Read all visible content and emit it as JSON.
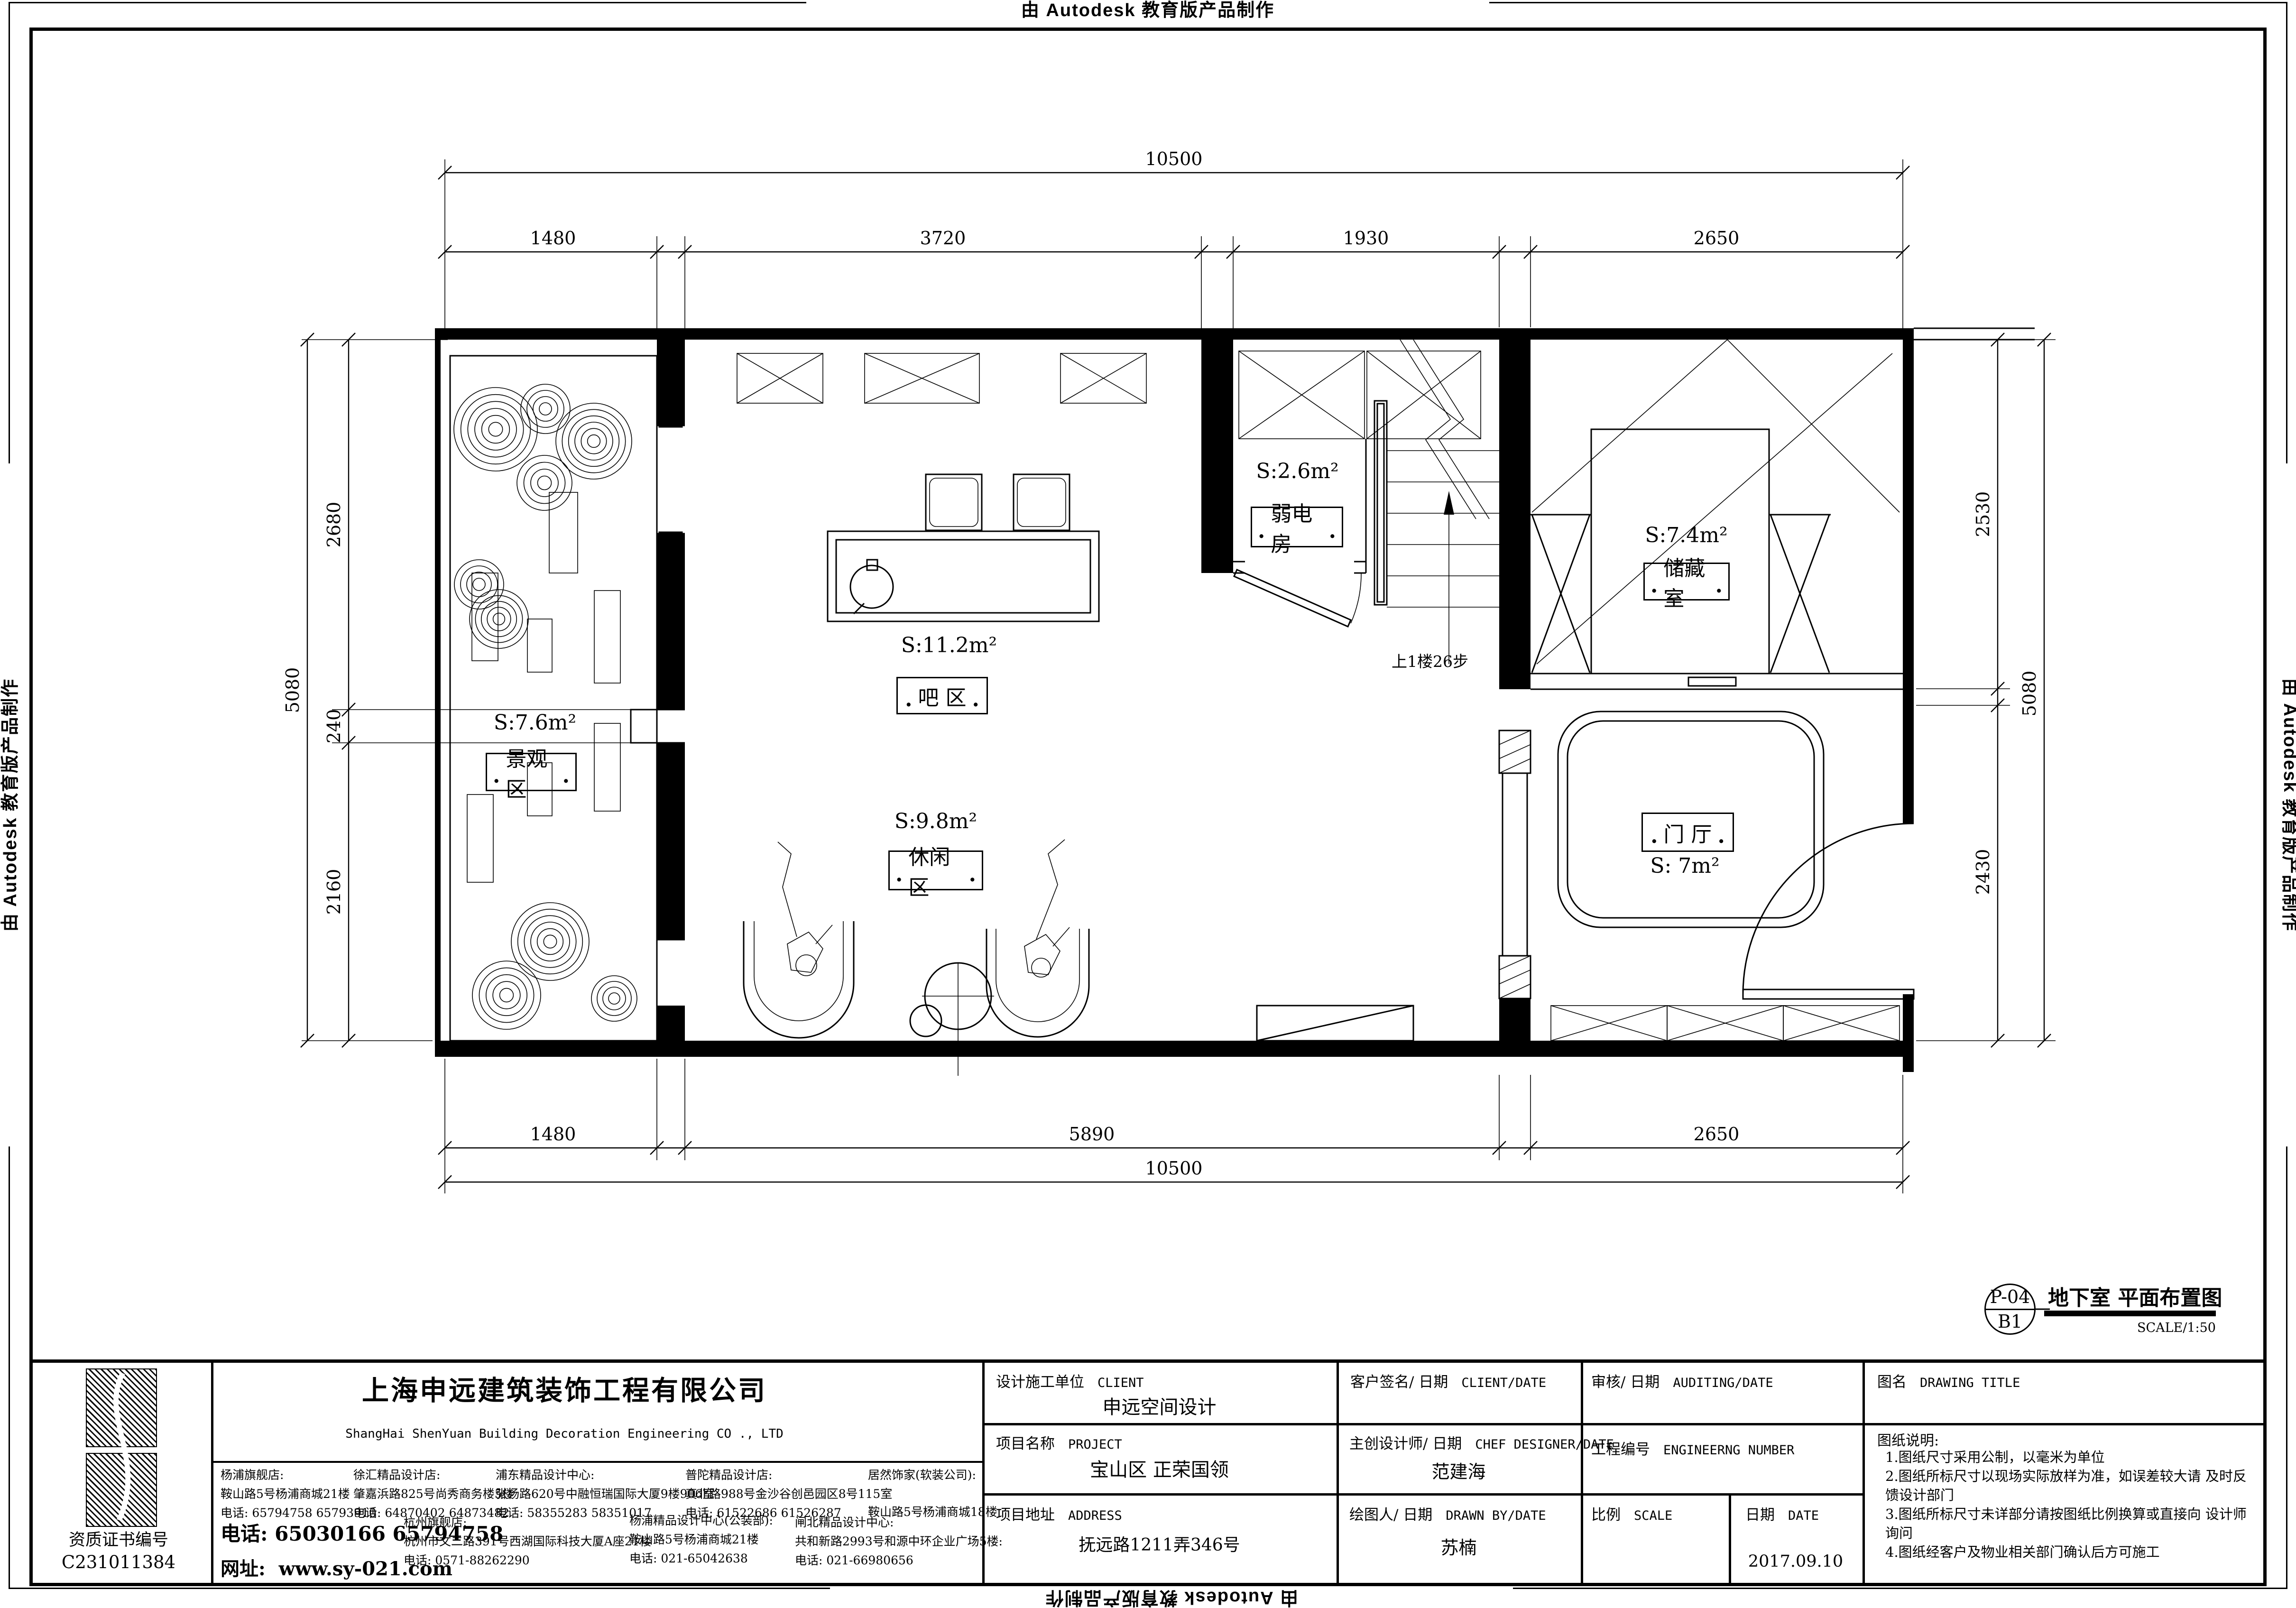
{
  "edge_stamps": {
    "top": "由 Autodesk 教育版产品制作",
    "bottom": "由 Autodesk 教育版产品制作",
    "left": "由 Autodesk 教育版产品制作",
    "right": "由 Autodesk 教育版产品制作"
  },
  "plan": {
    "rooms": [
      {
        "area": "S:7.6m²",
        "name": "景观区"
      },
      {
        "area": "S:11.2m²",
        "name": "吧 区"
      },
      {
        "area": "S:9.8m²",
        "name": "休闲区"
      },
      {
        "area": "S:2.6m²",
        "name": "弱电房"
      },
      {
        "area": "S:7.4m²",
        "name": "储藏室"
      },
      {
        "area": "S: 7m²",
        "name": "门 厅"
      }
    ],
    "stair_note": "上1楼26步",
    "dimensions": {
      "top_total": "10500",
      "top": [
        "1480",
        "3720",
        "1930",
        "2650"
      ],
      "bottom": [
        "1480",
        "5890",
        "2650"
      ],
      "bottom_total": "10500",
      "left_total": "5080",
      "left": [
        "2680",
        "240",
        "2160"
      ],
      "right": [
        "2530",
        "2430"
      ],
      "right_total": "5080"
    }
  },
  "sheet_stamp": {
    "sheet_no": "P-04",
    "level": "B1",
    "title": "地下室 平面布置图",
    "scale": "SCALE/1:50"
  },
  "titleblock": {
    "cert_label": "资质证书编号",
    "cert_no": "C231011384",
    "company_name": "上海申远建筑装饰工程有限公司",
    "company_name_en": "ShangHai ShenYuan Building Decoration Engineering CO ., LTD",
    "contact": {
      "phone_label": "电话:",
      "phone": "65030166 65794758",
      "web_label": "网址:",
      "web": "www.sy-021.com"
    },
    "stores": [
      {
        "name": "杨浦旗舰店:",
        "addr": "鞍山路5号杨浦商城21楼",
        "tel": "电话: 65794758 65793910"
      },
      {
        "name": "徐汇精品设计店:",
        "addr": "肇嘉浜路825号尚秀商务楼5楼",
        "tel": "电话: 64870402 64873482"
      },
      {
        "name": "浦东精品设计中心:",
        "addr": "张杨路620号中融恒瑞国际大厦9楼906室",
        "tel": "电话: 58355283 58351017"
      },
      {
        "name": "普陀精品设计店:",
        "addr": "真北路988号金沙谷创邑园区8号115室",
        "tel": "电话: 61522686 61526287"
      },
      {
        "name": "居然饰家(软装公司):",
        "addr": "鞍山路5号杨浦商城18楼",
        "tel": ""
      },
      {
        "name": "杭州旗舰店:",
        "addr": "杭州市文二路391号西湖国际科技大厦A座21楼",
        "tel": "电话: 0571-88262290"
      },
      {
        "name": "杨浦精品设计中心(公装部):",
        "addr": "鞍山路5号杨浦商城21楼",
        "tel": "电话: 021-65042638"
      },
      {
        "name": "闸北精品设计中心:",
        "addr": "共和新路2993号和源中环企业广场5楼:",
        "tel": "电话: 021-66980656"
      }
    ],
    "fields": {
      "client_label": "设计施工单位",
      "client_label_en": "CLIENT",
      "client_value": "申远空间设计",
      "client_sign_label": "客户签名/ 日期",
      "client_sign_label_en": "CLIENT/DATE",
      "audit_label": "审核/ 日期",
      "audit_label_en": "AUDITING/DATE",
      "drawing_title_label": "图名",
      "drawing_title_label_en": "DRAWING TITLE",
      "project_label": "项目名称",
      "project_label_en": "PROJECT",
      "project_value": "宝山区 正荣国领",
      "chief_label": "主创设计师/ 日期",
      "chief_label_en": "CHEF DESIGNER/DATE",
      "chief_value": "范建海",
      "eng_no_label": "工程编号",
      "eng_no_label_en": "ENGINEERNG NUMBER",
      "address_label": "项目地址",
      "address_label_en": "ADDRESS",
      "address_value": "抚远路1211弄346号",
      "drawn_label": "绘图人/ 日期",
      "drawn_label_en": "DRAWN BY/DATE",
      "drawn_value": "苏楠",
      "scale_label": "比例",
      "scale_label_en": "SCALE",
      "date_label": "日期",
      "date_label_en": "DATE",
      "date_value": "2017.09.10"
    },
    "notes": {
      "title": "图纸说明:",
      "items": [
        "1.图纸尺寸采用公制，以毫米为单位",
        "2.图纸所标尺寸以现场实际放样为准，如误差较大请 及时反馈设计部门",
        "3.图纸所标尺寸未详部分请按图纸比例换算或直接向 设计师询问",
        "4.图纸经客户及物业相关部门确认后方可施工"
      ]
    }
  }
}
